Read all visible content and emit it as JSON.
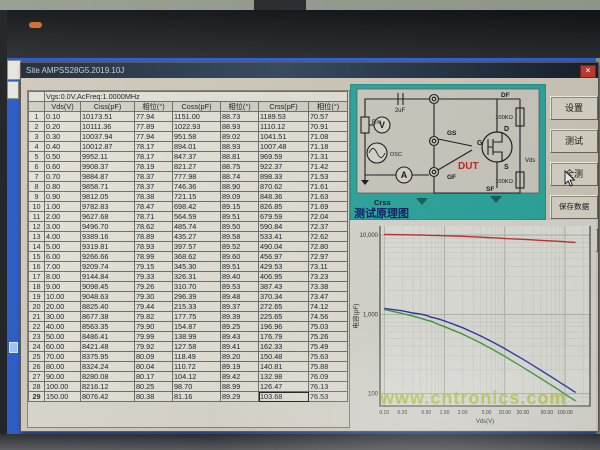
{
  "window": {
    "title": "Site AMPSS28G5.2019.10J",
    "close_label": "×"
  },
  "table": {
    "header": "Vgs:0.0V,AcFreq:1.0000MHz",
    "columns": [
      "Vds(V)",
      "Ciss(pF)",
      "相位(°)",
      "Coss(pF)",
      "相位(°)",
      "Crss(pF)",
      "相位(°)"
    ],
    "selected": {
      "row": 28,
      "col": 6,
      "value": "103.68"
    },
    "rows": [
      [
        "1",
        "0.10",
        "10173.51",
        "77.94",
        "1151.00",
        "88.73",
        "1189.53",
        "70.57"
      ],
      [
        "2",
        "0.20",
        "10111.36",
        "77.89",
        "1022.93",
        "88.93",
        "1110.12",
        "70.91"
      ],
      [
        "3",
        "0.30",
        "10037.94",
        "77.94",
        "951.58",
        "89.02",
        "1041.51",
        "71.08"
      ],
      [
        "4",
        "0.40",
        "10012.87",
        "78.17",
        "894.01",
        "88.93",
        "1007.48",
        "71.18"
      ],
      [
        "5",
        "0.50",
        "9952.11",
        "78.17",
        "847.37",
        "88.81",
        "969.59",
        "71.31"
      ],
      [
        "6",
        "0.60",
        "9908.37",
        "78.19",
        "821.27",
        "88.75",
        "922.37",
        "71.42"
      ],
      [
        "7",
        "0.70",
        "9884.87",
        "78.37",
        "777.98",
        "88.74",
        "898.33",
        "71.53"
      ],
      [
        "8",
        "0.80",
        "9858.71",
        "78.37",
        "746.36",
        "88.90",
        "870.62",
        "71.61"
      ],
      [
        "9",
        "0.90",
        "9812.05",
        "78.38",
        "721.15",
        "89.09",
        "848.36",
        "71.63"
      ],
      [
        "10",
        "1.00",
        "9782.83",
        "78.47",
        "698.42",
        "89.15",
        "826.85",
        "71.69"
      ],
      [
        "11",
        "2.00",
        "9627.68",
        "78.71",
        "564.59",
        "89.51",
        "679.59",
        "72.04"
      ],
      [
        "12",
        "3.00",
        "9496.70",
        "78.62",
        "485.74",
        "89.50",
        "590.84",
        "72.37"
      ],
      [
        "13",
        "4.00",
        "9389.16",
        "78.89",
        "435.27",
        "89.58",
        "533.41",
        "72.62"
      ],
      [
        "14",
        "5.00",
        "9319.81",
        "78.93",
        "397.57",
        "89.52",
        "490.04",
        "72.80"
      ],
      [
        "15",
        "6.00",
        "9266.66",
        "78.99",
        "368.62",
        "89.60",
        "456.97",
        "72.97"
      ],
      [
        "16",
        "7.00",
        "9209.74",
        "79.15",
        "345.30",
        "89.51",
        "429.53",
        "73.11"
      ],
      [
        "17",
        "8.00",
        "9144.84",
        "79.33",
        "326.31",
        "89.40",
        "406.95",
        "73.23"
      ],
      [
        "18",
        "9.00",
        "9098.45",
        "79.26",
        "310.70",
        "89.53",
        "387.43",
        "73.38"
      ],
      [
        "19",
        "10.00",
        "9048.63",
        "79.30",
        "296.39",
        "89.48",
        "370.34",
        "73.47"
      ],
      [
        "20",
        "20.00",
        "8825.40",
        "79.44",
        "215.33",
        "89.37",
        "272.65",
        "74.12"
      ],
      [
        "21",
        "30.00",
        "8677.38",
        "79.82",
        "177.75",
        "89.39",
        "225.65",
        "74.56"
      ],
      [
        "22",
        "40.00",
        "8563.35",
        "79.90",
        "154.87",
        "89.25",
        "196.96",
        "75.03"
      ],
      [
        "23",
        "50.00",
        "8486.41",
        "79.99",
        "138.99",
        "89.43",
        "176.79",
        "75.26"
      ],
      [
        "24",
        "60.00",
        "8421.48",
        "79.92",
        "127.58",
        "89.41",
        "162.33",
        "75.49"
      ],
      [
        "25",
        "70.00",
        "8375.95",
        "80.09",
        "118.49",
        "89.20",
        "150.48",
        "75.63"
      ],
      [
        "26",
        "80.00",
        "8324.24",
        "80.04",
        "110.72",
        "89.19",
        "140.81",
        "75.88"
      ],
      [
        "27",
        "90.00",
        "8280.08",
        "80.17",
        "104.12",
        "89.42",
        "132.98",
        "76.09"
      ],
      [
        "28",
        "100.00",
        "8216.12",
        "80.25",
        "98.70",
        "88.99",
        "126.47",
        "76.13"
      ],
      [
        "29",
        "150.00",
        "8076.42",
        "80.38",
        "81.16",
        "89.29",
        "103.68",
        "76.53"
      ]
    ]
  },
  "buttons": {
    "settings": "设置",
    "test": "测试",
    "test_all": "全测",
    "save_data": "保存数据",
    "save_site": "另存Site"
  },
  "diagram": {
    "rm": "Rm",
    "cap": "2uF",
    "v": "V",
    "osc": "OSC",
    "a": "A",
    "gs": "GS",
    "gf": "GF",
    "df": "DF",
    "sf": "SF",
    "d": "D",
    "g": "G",
    "s": "S",
    "dut": "DUT",
    "r1": "100KΩ",
    "r2": "100KΩ",
    "vds": "Vds",
    "mode": "Crss",
    "caption": "测试原理图"
  },
  "chart_data": {
    "type": "line",
    "scale": "log-log",
    "xlabel": "Vds(V)",
    "ylabel": "电容(pF)",
    "xlim": [
      0.1,
      200
    ],
    "ylim": [
      80,
      12000
    ],
    "grid": true,
    "watermark": "www.cntronics.com",
    "x": [
      0.1,
      0.2,
      0.3,
      0.4,
      0.5,
      0.6,
      0.7,
      0.8,
      0.9,
      1,
      2,
      3,
      4,
      5,
      6,
      7,
      8,
      9,
      10,
      20,
      30,
      40,
      50,
      60,
      70,
      80,
      90,
      100,
      150
    ],
    "series": [
      {
        "name": "Ciss",
        "color": "#c1322a",
        "values": [
          10173.51,
          10111.36,
          10037.94,
          10012.87,
          9952.11,
          9908.37,
          9884.87,
          9858.71,
          9812.05,
          9782.83,
          9627.68,
          9496.7,
          9389.16,
          9319.81,
          9266.66,
          9209.74,
          9144.84,
          9098.45,
          9048.63,
          8825.4,
          8677.38,
          8563.35,
          8486.41,
          8421.48,
          8375.95,
          8324.24,
          8280.08,
          8216.12,
          8076.42
        ]
      },
      {
        "name": "Crss",
        "color": "#2a35a5",
        "values": [
          1189.53,
          1110.12,
          1041.51,
          1007.48,
          969.59,
          922.37,
          898.33,
          870.62,
          848.36,
          826.85,
          679.59,
          590.84,
          533.41,
          490.04,
          456.97,
          429.53,
          406.95,
          387.43,
          370.34,
          272.65,
          225.65,
          196.96,
          176.79,
          162.33,
          150.48,
          140.81,
          132.98,
          126.47,
          103.68
        ]
      },
      {
        "name": "Coss",
        "color": "#3c9a3c",
        "values": [
          1151.0,
          1022.93,
          951.58,
          894.01,
          847.37,
          821.27,
          777.98,
          746.36,
          721.15,
          698.42,
          564.59,
          485.74,
          435.27,
          397.57,
          368.62,
          345.3,
          326.31,
          310.7,
          296.39,
          215.33,
          177.75,
          154.87,
          138.99,
          127.58,
          118.49,
          110.72,
          104.12,
          98.7,
          81.16
        ]
      }
    ],
    "x_ticks": [
      {
        "v": 0.1,
        "label": "0.10"
      },
      {
        "v": 0.2,
        "label": "0.20"
      },
      {
        "v": 0.5,
        "label": "0.50"
      },
      {
        "v": 1,
        "label": "1.00"
      },
      {
        "v": 2,
        "label": "2.00"
      },
      {
        "v": 5,
        "label": "5.00"
      },
      {
        "v": 10,
        "label": "10.00"
      },
      {
        "v": 20,
        "label": "20.00"
      },
      {
        "v": 50,
        "label": "50.00"
      },
      {
        "v": 100,
        "label": "100.00"
      }
    ],
    "y_ticks": [
      {
        "v": 10000,
        "label": "10,000"
      },
      {
        "v": 1000,
        "label": "1,000"
      },
      {
        "v": 100,
        "label": "100"
      }
    ]
  }
}
